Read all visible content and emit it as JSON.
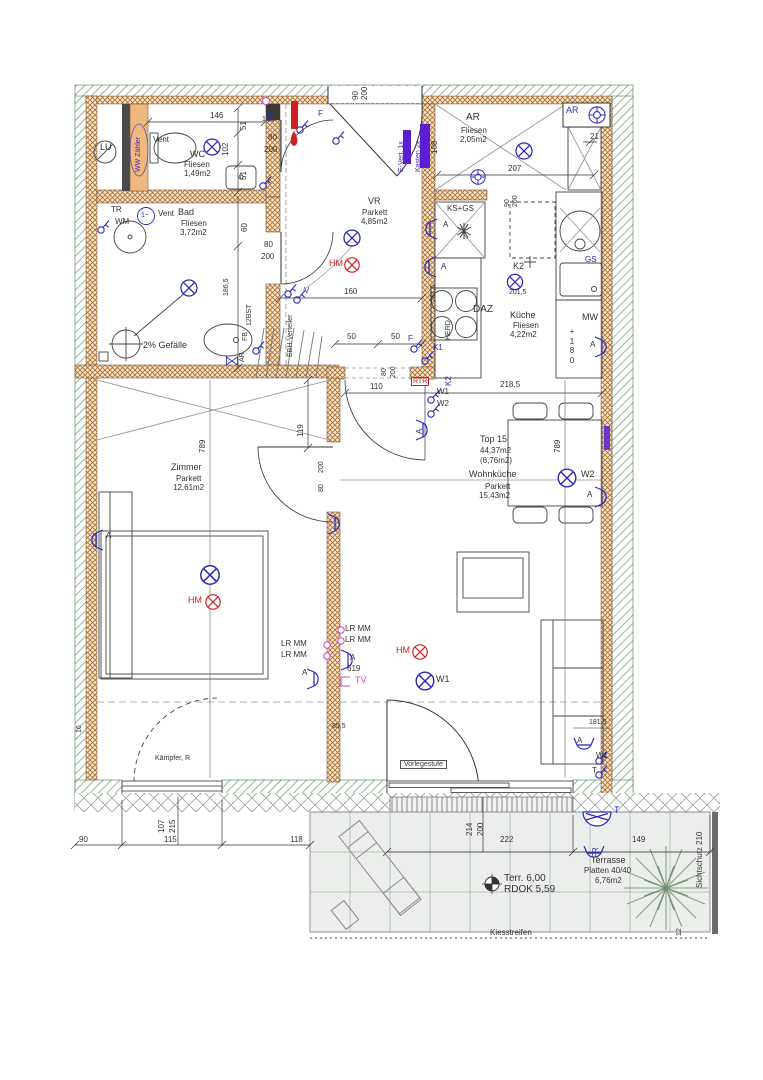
{
  "plan": {
    "rooms": {
      "wc": {
        "vent": "Vent",
        "name": "WC",
        "floor": "Fliesen",
        "area": "1,49m2"
      },
      "bad": {
        "vent": "Vent",
        "name": "Bad",
        "floor": "Fliesen",
        "area": "3,72m2",
        "gefaelle": "2% Gefälle"
      },
      "vr": {
        "name": "VR",
        "floor": "Parkett",
        "area": "4,85m2"
      },
      "ar": {
        "name": "AR",
        "floor": "Fliesen",
        "area": "2,05m2"
      },
      "kueche": {
        "name": "Küche",
        "floor": "Fliesen",
        "area": "4,22m2"
      },
      "zimmer": {
        "name": "Zimmer",
        "floor": "Parkett",
        "area": "12,61m2"
      },
      "wohn": {
        "unit": "Top 15",
        "unit_area": "44,37m2",
        "terr_area": "(6,76m2)",
        "name": "Wohnküche",
        "floor": "Parkett",
        "area": "15,43m2"
      },
      "terrasse": {
        "name": "Terrasse",
        "floor": "Platten 40/40",
        "area": "6,76m2"
      }
    },
    "tech": {
      "lu": "LU",
      "ww": "WW Zähler",
      "tr": "TR",
      "wm": "WM",
      "phase": "1~",
      "evert": "E-Vert. 1x",
      "kasten": "Kasten 2x",
      "ebh": "EBH-Verteiler",
      "bst": "12BST",
      "fb": "FB",
      "ar": "AR",
      "ks_gs": "KS+GS",
      "gs": "GS",
      "daz": "DAZ",
      "herd": "HERD",
      "mw": "MW",
      "mw_stack": "+\n1\n8\n0",
      "k1": "K1",
      "k2": "K2",
      "rtr": "RTR",
      "hm": "HM",
      "w1": "W1",
      "w2": "W2",
      "lr": "LR",
      "lrmm": "LR MM",
      "a": "A",
      "t": "T",
      "f": "F",
      "v": "V",
      "tv": "TV",
      "fr": "FR"
    },
    "notes": {
      "kaempfer": "Kämpfer, R",
      "vorlege": "Vorlegestufe",
      "kies": "Kiesstreifen",
      "sicht": "Sichtschutz 210",
      "terr_lvl": "Terr. 6,00",
      "rdok": "RDOK 5,59"
    },
    "dims": {
      "d10": "10",
      "d12": "12",
      "d16": "16",
      "d21": "21",
      "d50": "50",
      "d51": "51",
      "d60": "60",
      "d80": "80",
      "d90": "90",
      "d102": "102",
      "d107": "107",
      "d108": "108",
      "d110": "110",
      "d115": "115",
      "d118": "118",
      "d119": "119",
      "d146": "146",
      "d149": "149",
      "d160": "160",
      "d181_5": "181,5",
      "d186_5": "186,5",
      "d200": "200",
      "d201_5": "201,5",
      "d207": "207",
      "d214": "214",
      "d215": "215",
      "d218_5": "218,5",
      "d222": "222",
      "d619": "619",
      "d789": "789",
      "d85_5": "85,5"
    }
  }
}
